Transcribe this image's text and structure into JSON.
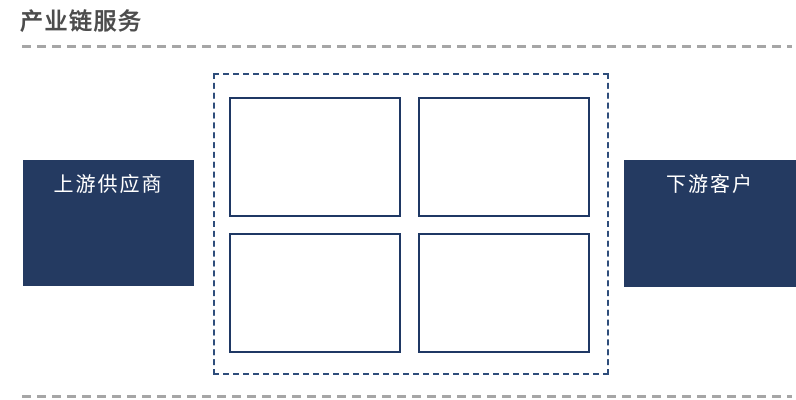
{
  "colors": {
    "background": "#ffffff",
    "title_text": "#4d4d4d",
    "gray_dash": "#a6a6a6",
    "navy_fill": "#243a61",
    "navy_border": "#1f3864",
    "dashed_border": "#2e4d7b",
    "node_text": "#ffffff"
  },
  "header": {
    "title": "产业链服务"
  },
  "diagram": {
    "left_node": {
      "label": "上游供应商"
    },
    "right_node": {
      "label": "下游客户"
    },
    "center_grid": {
      "box_count": 4,
      "boxes": [
        {
          "label": ""
        },
        {
          "label": ""
        },
        {
          "label": ""
        },
        {
          "label": ""
        }
      ]
    }
  }
}
